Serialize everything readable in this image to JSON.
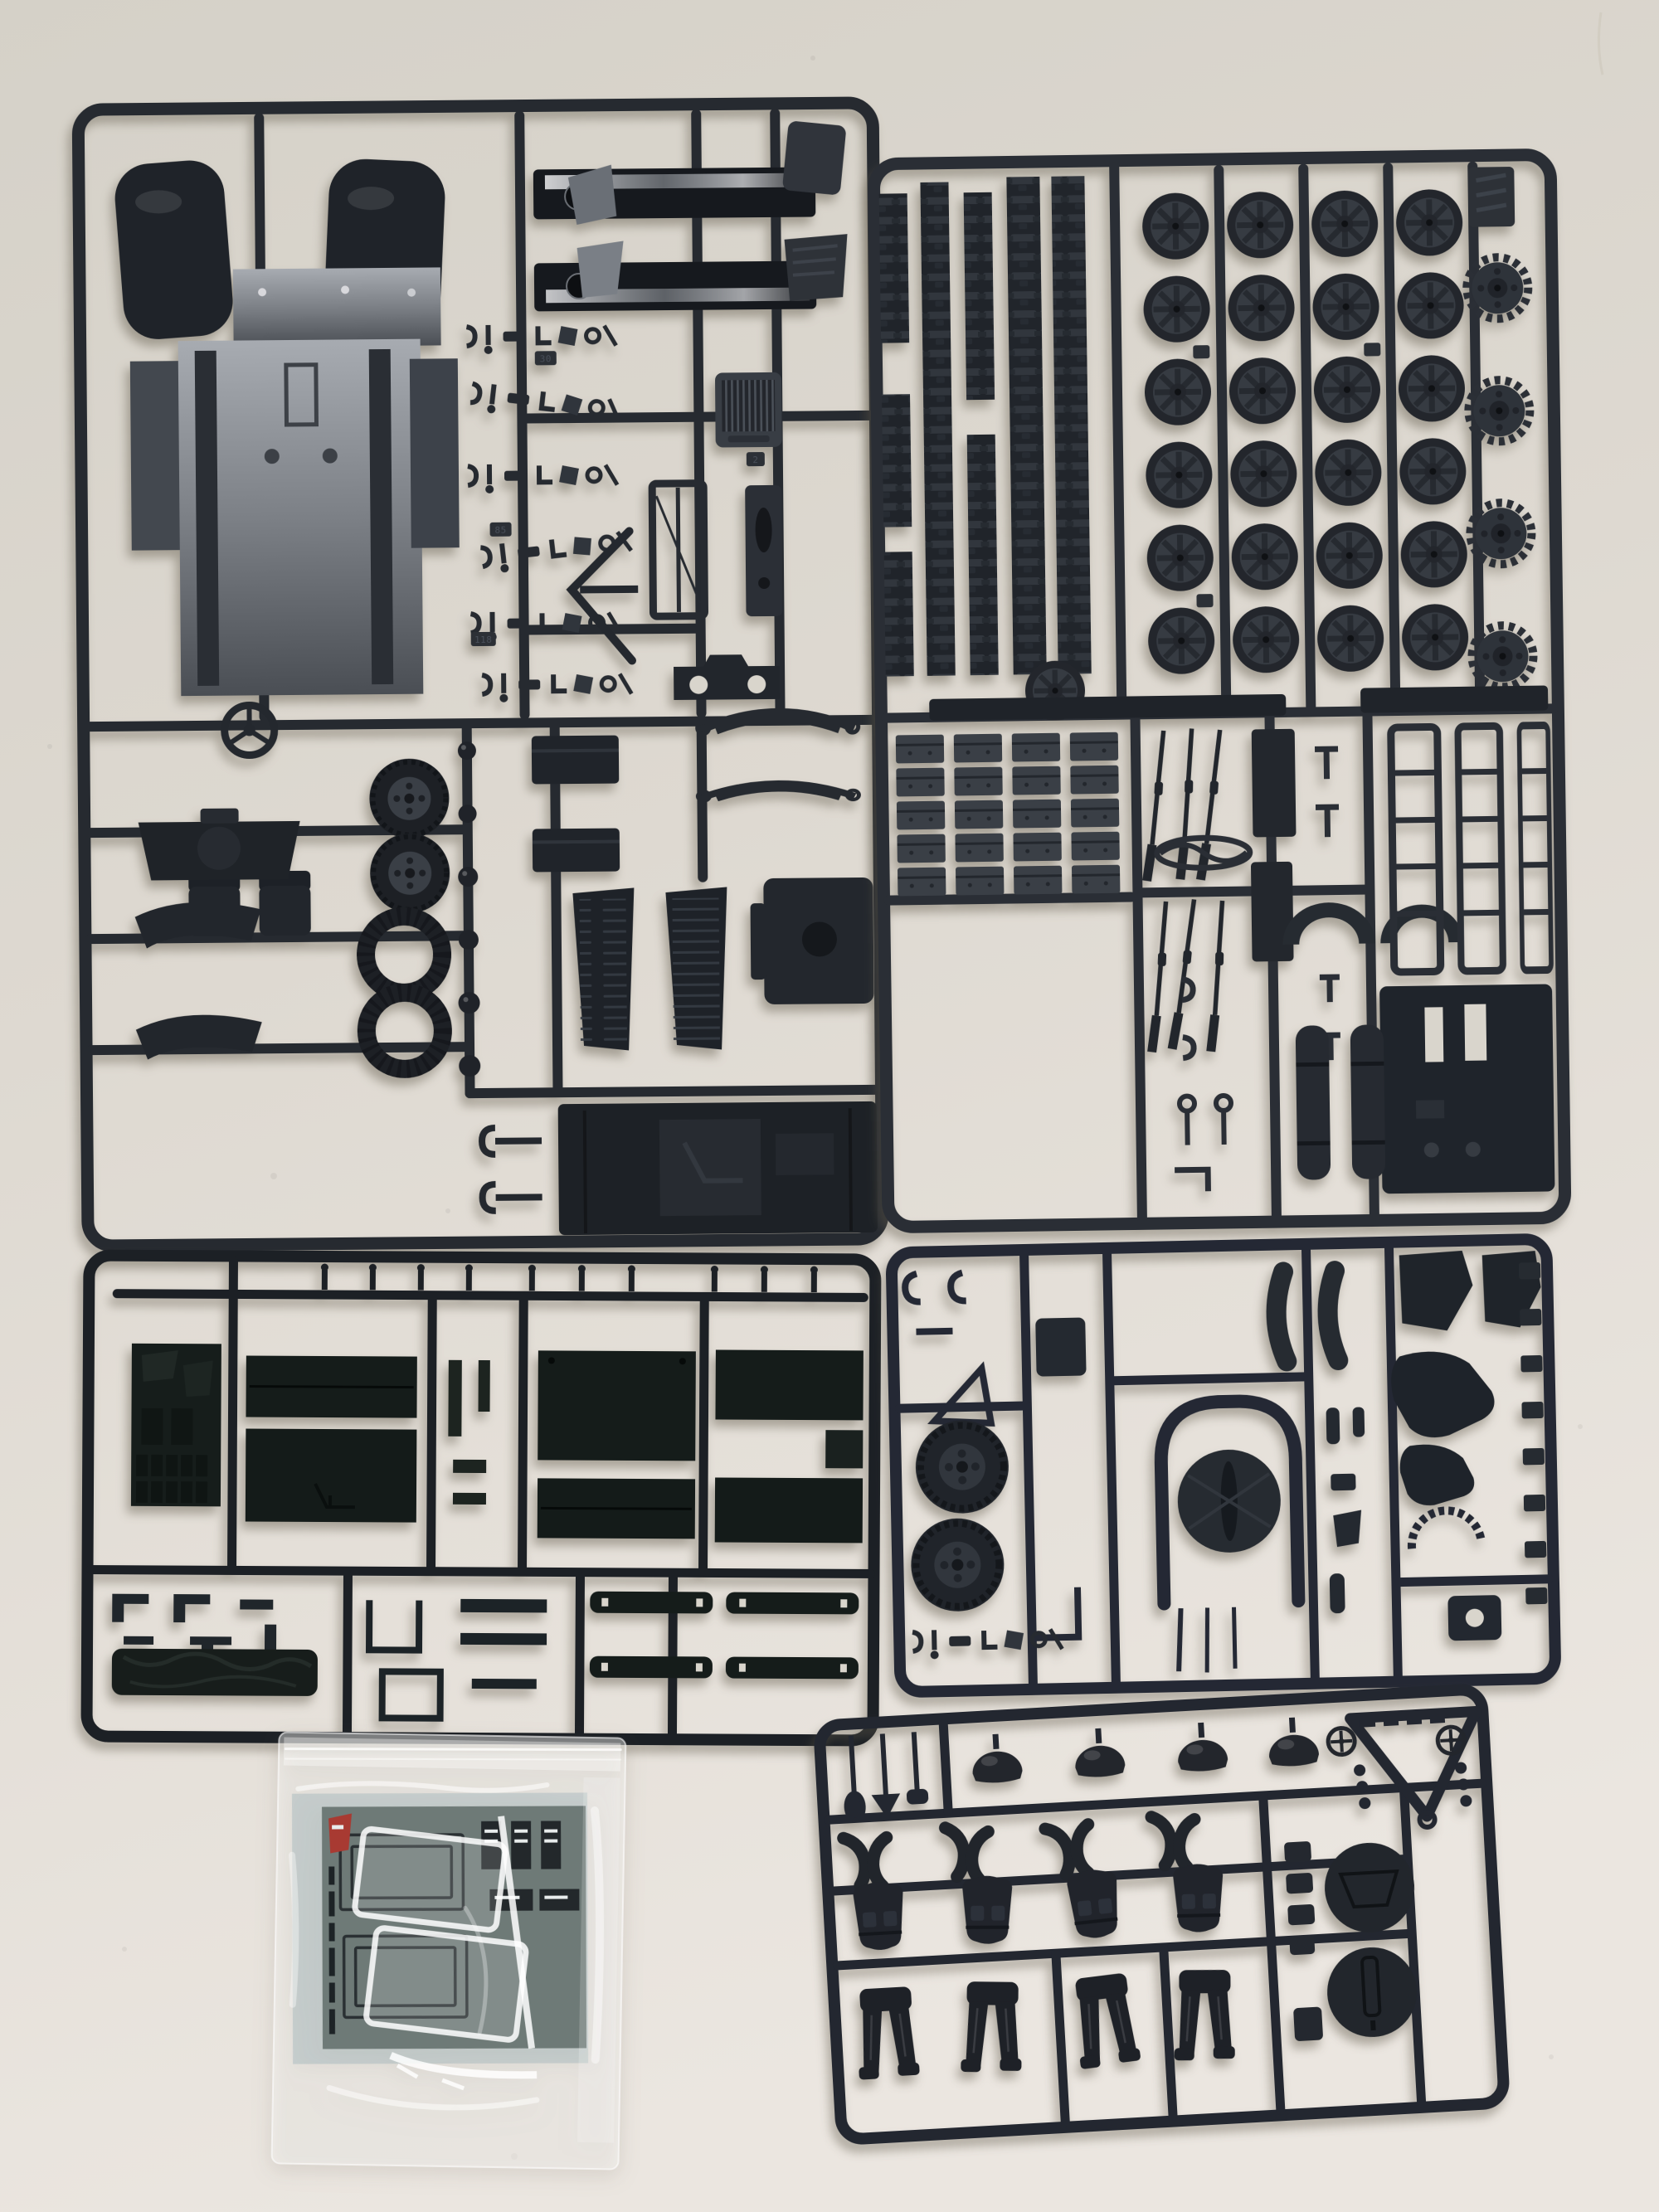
{
  "page": {
    "title": "Photograph of an unassembled plastic scale-model kit",
    "type": "photograph"
  },
  "scene": {
    "subject": "Five dark grey/green injection-moulded sprues (runners) of military truck, wheel, track and crew-figure parts laid out on a pale cream tabletop, with a clear resealable bag containing a decal sheet and clear glazing parts at lower left",
    "lighting": "soft diffuse light from upper right, shadows falling to lower left",
    "layout": [
      "top-left: chassis and cab parts sprue",
      "top-right: wheels and track links sprue",
      "mid-left: cargo bed flat panels sprue",
      "mid-right: gun and accessories sprue",
      "bottom-right: crew figures sprue (slightly tilted)",
      "bottom-left: clear zip bag with decal sheet"
    ]
  },
  "colors": {
    "background_top": "#d5d1c8",
    "background_mid": "#ded9d1",
    "background_bottom": "#ebe6e0",
    "sprue_a_plastic": "#262a30",
    "sprue_b_plastic": "#2a2e35",
    "sprue_c_plastic": "#1c2025",
    "sprue_d_plastic": "#242834",
    "sprue_e_plastic": "#232730",
    "panel_green_black": "#151c1a",
    "part_grey": "#383d44",
    "chassis_metal_light": "#a7abb1",
    "chassis_metal_dark": "#4a4e54",
    "decal_sheet": "#6e7a77",
    "decal_red": "#a83a32",
    "bag_film": "rgba(252,252,250,0.42)"
  },
  "inventory": {
    "sprues": [
      {
        "id": "chassis-cab",
        "position": "top-left",
        "parts": [
          "cab floor pan with two dark wheel-arch fenders",
          "two glossy chassis side rails with lightening hole",
          "radiator grille",
          "windscreen frame",
          "dashboard panel",
          "front bumper with two holes",
          "steering wheel",
          "two seats",
          "front axle housing",
          "two wheels with tyres",
          "two spare tyre rings",
          "two curved mudguards",
          "two leaf springs",
          "two stowage boxes",
          "two louvred bonnet side panels",
          "firewall block",
          "cargo-bed floor panel with transmission hump",
          "numerous small levers, hooks, pedals and linkages"
        ]
      },
      {
        "id": "wheels-tracks",
        "position": "top-right",
        "parts": [
          "five vertical strips of tank-track links",
          "24 spoked road wheels in a 4x6 grid",
          "four toothed drive sprockets",
          "one loose hub wheel",
          "20 stowage crates in a 4x5 grid",
          "six rifles",
          "three ladder-style racks",
          "large slotted floor panel",
          "two strapped bedrolls",
          "two wheel-arch shells",
          "tow-cable loop",
          "two stake beams",
          "assorted clips, buckles and pins",
          "embossed maker plate"
        ]
      },
      {
        "id": "cargo-panels",
        "position": "mid-left",
        "parts": [
          "textured cab back panel with ribbed base",
          "six large flat bed panels with plank grooves",
          "four narrow bed slats with notched ends",
          "rolled tarpaulin",
          "rows of small pins, clips and angle brackets"
        ]
      },
      {
        "id": "gun-accessories",
        "position": "mid-right",
        "parts": [
          "two treaded road wheels",
          "round machine-gun shield on arched mount",
          "thin gun barrels",
          "two curved seat cushions",
          "two angular fenders",
          "irregular gun-cradle castings",
          "toothed elevation arc",
          "mounting bracket with hole",
          "row of ammunition clips along right edge",
          "small cylinders, cones and clamps",
          "C-hooks and jack stand"
        ]
      },
      {
        "id": "crew-figures",
        "position": "bottom-right",
        "parts": [
          "four domed helmets",
          "four pairs of arms",
          "four torsos with webbing pouches",
          "four pairs of standing legs",
          "two engraved circular equipment discs",
          "towing A-frame with castellated edge",
          "two small spoked handwheels",
          "ball chains",
          "entrenching tools",
          "five belt pouches"
        ]
      }
    ],
    "bag": {
      "type": "resealable clear zip bag",
      "contents": [
        "grey-green decal sheet with license-plate markings, illegible vertical product print and a red printer's mark",
        "clear windscreen glazing sprue"
      ]
    },
    "counts": {
      "sprues": 5,
      "road_wheels": 24,
      "drive_sprockets": 4,
      "stowage_crates": 20,
      "rifles": 6,
      "track_strips": 5,
      "helmets": 4,
      "torsos": 4,
      "leg_pairs": 4,
      "arm_pairs": 4,
      "equipment_discs": 2,
      "large_bed_panels": 7,
      "bed_slats": 4,
      "ladder_racks": 3
    },
    "embossed_part_numbers": [
      "85",
      "118",
      "30",
      "2"
    ]
  }
}
